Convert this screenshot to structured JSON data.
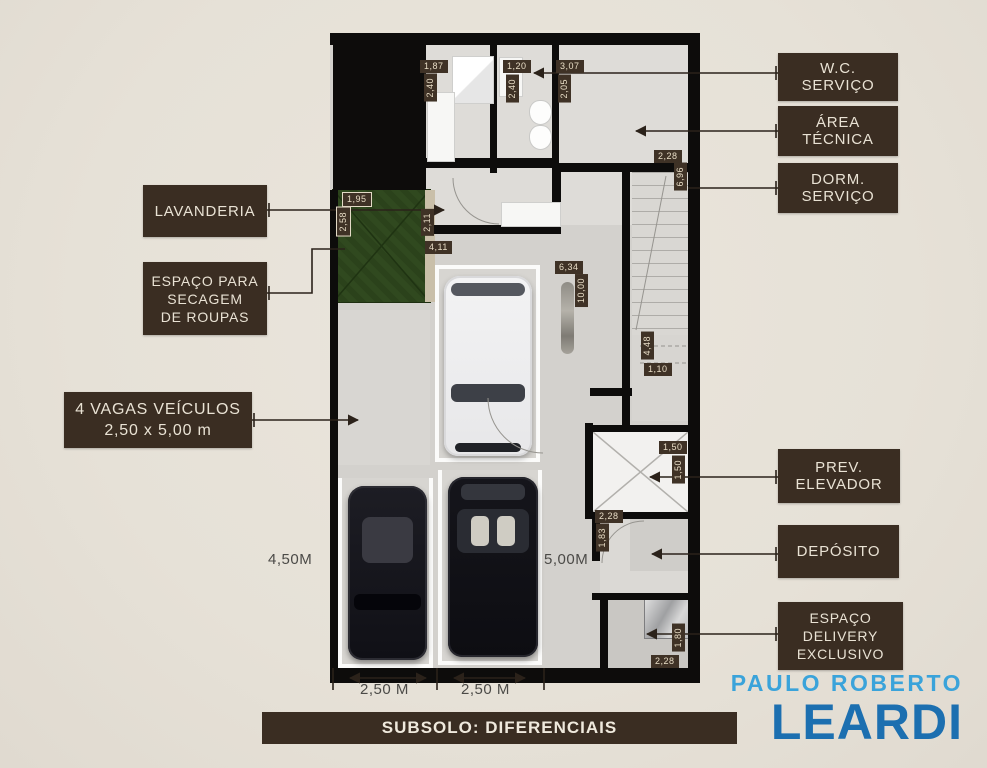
{
  "title": "Planta do subsolo",
  "footer": {
    "title": "SUBSOLO: DIFERENCIAIS"
  },
  "brand": {
    "top": "PAULO ROBERTO",
    "name": "LEARDI"
  },
  "theme": {
    "background": "#e6e1d7",
    "callout_bg": "#3a2d22",
    "callout_text": "#e9e2d4",
    "dim_bg": "#3f3226",
    "dim_text": "#e8ddc6",
    "wall": "#0d0c0b",
    "floor": "#d3d1cd",
    "grass": "#30491f",
    "stall_line": "#fbfbfa",
    "brand_top_blue": "#3aa3da",
    "brand_main_blue": "#1c6fb0"
  },
  "callouts": {
    "wc": {
      "lines": [
        "W.C.",
        "SERVIÇO"
      ]
    },
    "area_tecnica": {
      "lines": [
        "ÁREA",
        "TÉCNICA"
      ]
    },
    "dorm": {
      "lines": [
        "DORM.",
        "SERVIÇO"
      ]
    },
    "lavanderia": {
      "label": "LAVANDERIA"
    },
    "secagem": {
      "lines": [
        "ESPAÇO PARA",
        "SECAGEM",
        "DE ROUPAS"
      ]
    },
    "vagas": {
      "lines": [
        "4 VAGAS VEÍCULOS",
        "2,50 x  5,00 m"
      ]
    },
    "prev_elevador": {
      "lines": [
        "PREV.",
        "ELEVADOR"
      ]
    },
    "deposito": {
      "label": "DEPÓSITO"
    },
    "delivery": {
      "lines": [
        "ESPAÇO",
        "DELIVERY",
        "EXCLUSIVO"
      ]
    }
  },
  "dimensions": [
    {
      "t": "1,87",
      "x": 420,
      "y": 60,
      "o": "h"
    },
    {
      "t": "2,40",
      "x": 424,
      "y": 74,
      "o": "v"
    },
    {
      "t": "1,20",
      "x": 503,
      "y": 60,
      "o": "h"
    },
    {
      "t": "2,40",
      "x": 506,
      "y": 75,
      "o": "v"
    },
    {
      "t": "3,07",
      "x": 556,
      "y": 60,
      "o": "h"
    },
    {
      "t": "2,05",
      "x": 558,
      "y": 75,
      "o": "v"
    },
    {
      "t": "2,28",
      "x": 654,
      "y": 150,
      "o": "h"
    },
    {
      "t": "6,96",
      "x": 674,
      "y": 163,
      "o": "v"
    },
    {
      "t": "1,95",
      "x": 342,
      "y": 192,
      "o": "h",
      "b": true
    },
    {
      "t": "2,58",
      "x": 336,
      "y": 207,
      "o": "v",
      "b": true
    },
    {
      "t": "2,11",
      "x": 421,
      "y": 209,
      "o": "v"
    },
    {
      "t": "4,11",
      "x": 425,
      "y": 241,
      "o": "h"
    },
    {
      "t": "6,34",
      "x": 555,
      "y": 261,
      "o": "h"
    },
    {
      "t": "10,00",
      "x": 575,
      "y": 274,
      "o": "v"
    },
    {
      "t": "4,48",
      "x": 641,
      "y": 332,
      "o": "v"
    },
    {
      "t": "1,10",
      "x": 644,
      "y": 363,
      "o": "h"
    },
    {
      "t": "1,50",
      "x": 659,
      "y": 441,
      "o": "h"
    },
    {
      "t": "1,50",
      "x": 672,
      "y": 456,
      "o": "v"
    },
    {
      "t": "2,28",
      "x": 595,
      "y": 510,
      "o": "h"
    },
    {
      "t": "1,83",
      "x": 596,
      "y": 524,
      "o": "v"
    },
    {
      "t": "1,80",
      "x": 672,
      "y": 624,
      "o": "v"
    },
    {
      "t": "2,28",
      "x": 651,
      "y": 655,
      "o": "h"
    }
  ],
  "measurements": [
    {
      "t": "4,50M",
      "x": 268,
      "y": 551
    },
    {
      "t": "5,00M",
      "x": 544,
      "y": 551
    },
    {
      "t": "2,50 M",
      "x": 360,
      "y": 681
    },
    {
      "t": "2,50 M",
      "x": 461,
      "y": 681
    }
  ]
}
